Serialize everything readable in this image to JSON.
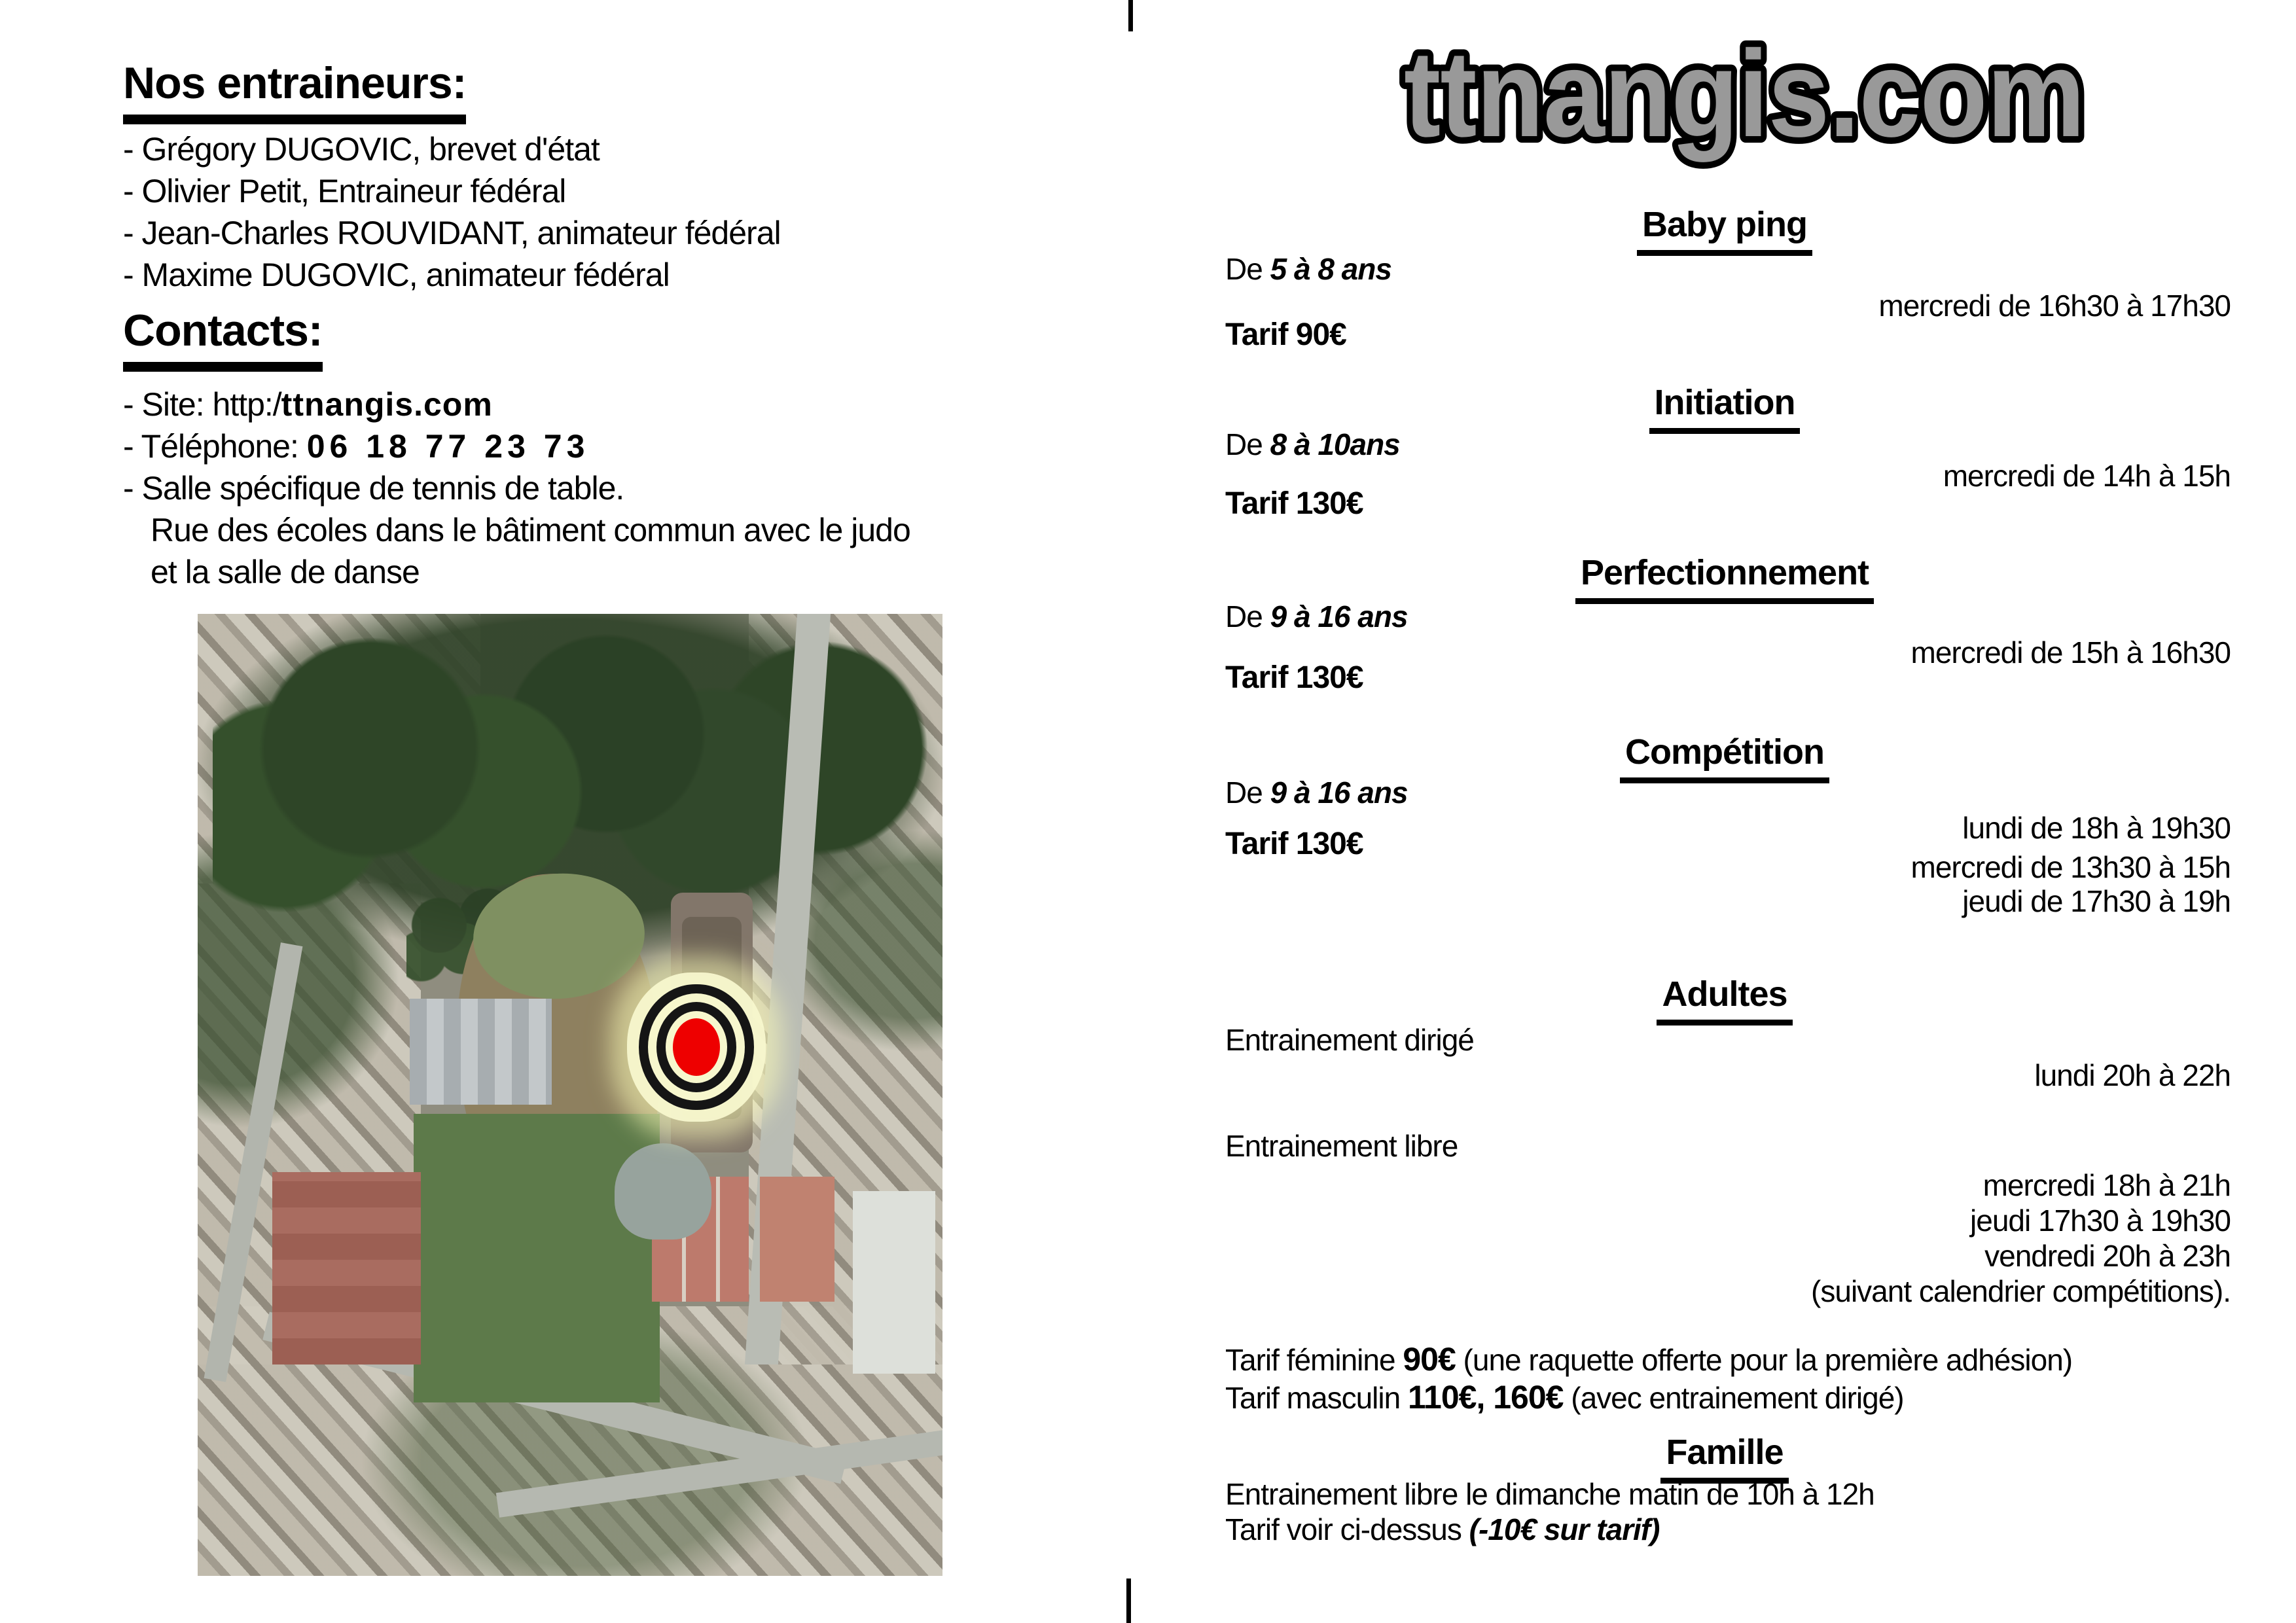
{
  "left": {
    "trainers": {
      "heading": "Nos entraineurs:",
      "items": [
        "- Grégory DUGOVIC, brevet d'état",
        "- Olivier Petit, Entraineur fédéral",
        "- Jean-Charles ROUVIDANT, animateur fédéral",
        "- Maxime DUGOVIC, animateur fédéral"
      ]
    },
    "contacts": {
      "heading": "Contacts:",
      "site_prefix": "- Site: http:/",
      "site_domain": "ttnangis.com",
      "phone_prefix": "- Téléphone: ",
      "phone_number": "06 18 77 23 73",
      "hall_line1": "- Salle spécifique de tennis de table.",
      "hall_line2": "Rue des écoles dans le bâtiment commun avec le judo",
      "hall_line3": "et la salle de danse"
    },
    "map": {
      "marker_color": "#ee0000"
    }
  },
  "logo": {
    "text": "ttnangis.com",
    "fill": "#999999",
    "outline": "#000000"
  },
  "sections": {
    "baby": {
      "title": "Baby ping",
      "age_prefix": "De ",
      "age": "5 à 8 ans",
      "time": "mercredi de 16h30 à 17h30",
      "tarif": "Tarif 90€"
    },
    "initiation": {
      "title": "Initiation",
      "age_prefix": "De ",
      "age": "8 à 10ans",
      "time": "mercredi de 14h à 15h",
      "tarif": "Tarif 130€"
    },
    "perfectionnement": {
      "title": "Perfectionnement",
      "age_prefix": "De ",
      "age": "9 à 16 ans",
      "time": "mercredi de 15h à 16h30",
      "tarif": "Tarif 130€"
    },
    "competition": {
      "title": "Compétition",
      "age_prefix": "De ",
      "age": "9 à 16 ans",
      "tarif": "Tarif 130€",
      "times": [
        "lundi de 18h à 19h30",
        "mercredi de 13h30 à 15h",
        "jeudi de 17h30 à 19h"
      ]
    },
    "adultes": {
      "title": "Adultes",
      "dirige_label": "Entrainement dirigé",
      "dirige_time": "lundi 20h à 22h",
      "libre_label": "Entrainement libre",
      "libre_times": [
        "mercredi 18h à 21h",
        "jeudi 17h30 à 19h30",
        "vendredi 20h à 23h",
        "(suivant calendrier compétitions)."
      ],
      "tarif_feminine_prefix": "Tarif féminine ",
      "tarif_feminine_value": "90€",
      "tarif_feminine_suffix": " (une raquette offerte pour la première adhésion)",
      "tarif_masculin_prefix": "Tarif masculin ",
      "tarif_masculin_value": "110€, 160€",
      "tarif_masculin_suffix": " (avec entrainement dirigé)"
    },
    "famille": {
      "title": "Famille",
      "line1": "Entrainement libre le dimanche matin de 10h à 12h",
      "line2_prefix": "Tarif voir ci-dessus ",
      "line2_bold": "(-10€ sur tarif)"
    }
  }
}
